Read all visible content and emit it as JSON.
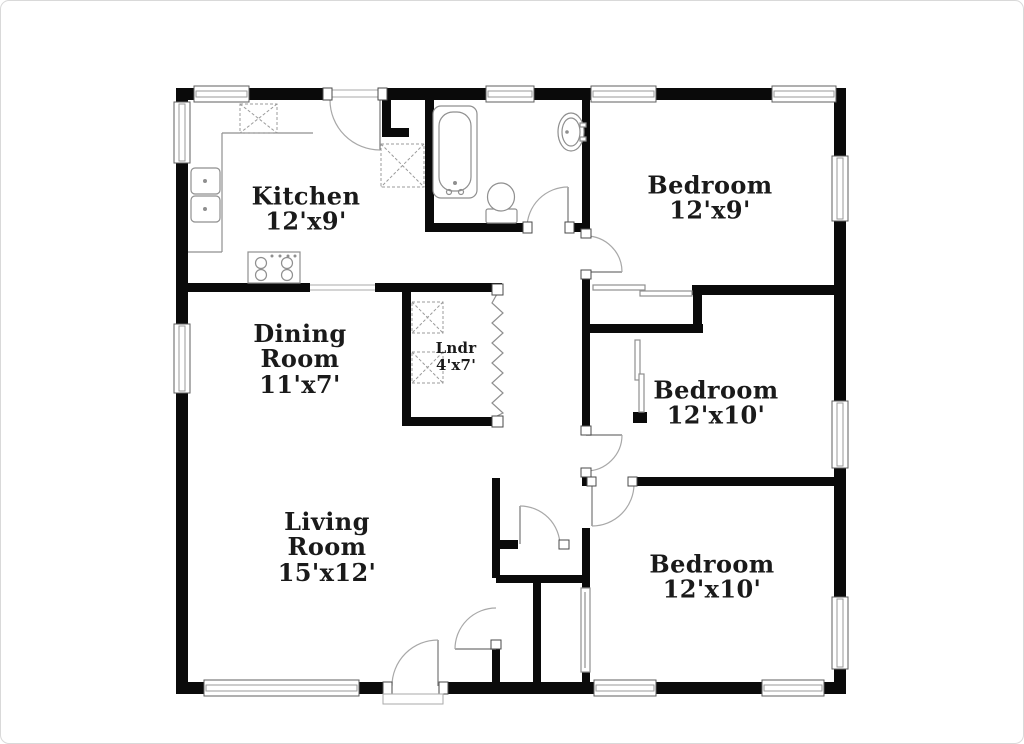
{
  "plan": {
    "colors": {
      "wall": "#0a0a0a",
      "label": "#1a1a1a",
      "fixture": "#8f8f8f"
    },
    "rooms": [
      {
        "key": "kitchen",
        "lines": [
          "Kitchen",
          "12'x9'"
        ]
      },
      {
        "key": "bedroom-top-right",
        "lines": [
          "Bedroom",
          "12'x9'"
        ]
      },
      {
        "key": "dining-room",
        "lines": [
          "Dining",
          "Room",
          "11'x7'"
        ]
      },
      {
        "key": "laundry",
        "lines": [
          "Lndr",
          "4'x7'"
        ]
      },
      {
        "key": "bedroom-middle-right",
        "lines": [
          "Bedroom",
          "12'x10'"
        ]
      },
      {
        "key": "living-room",
        "lines": [
          "Living",
          "Room",
          "15'x12'"
        ]
      },
      {
        "key": "bedroom-bottom-right",
        "lines": [
          "Bedroom",
          "12'x10'"
        ]
      }
    ]
  }
}
